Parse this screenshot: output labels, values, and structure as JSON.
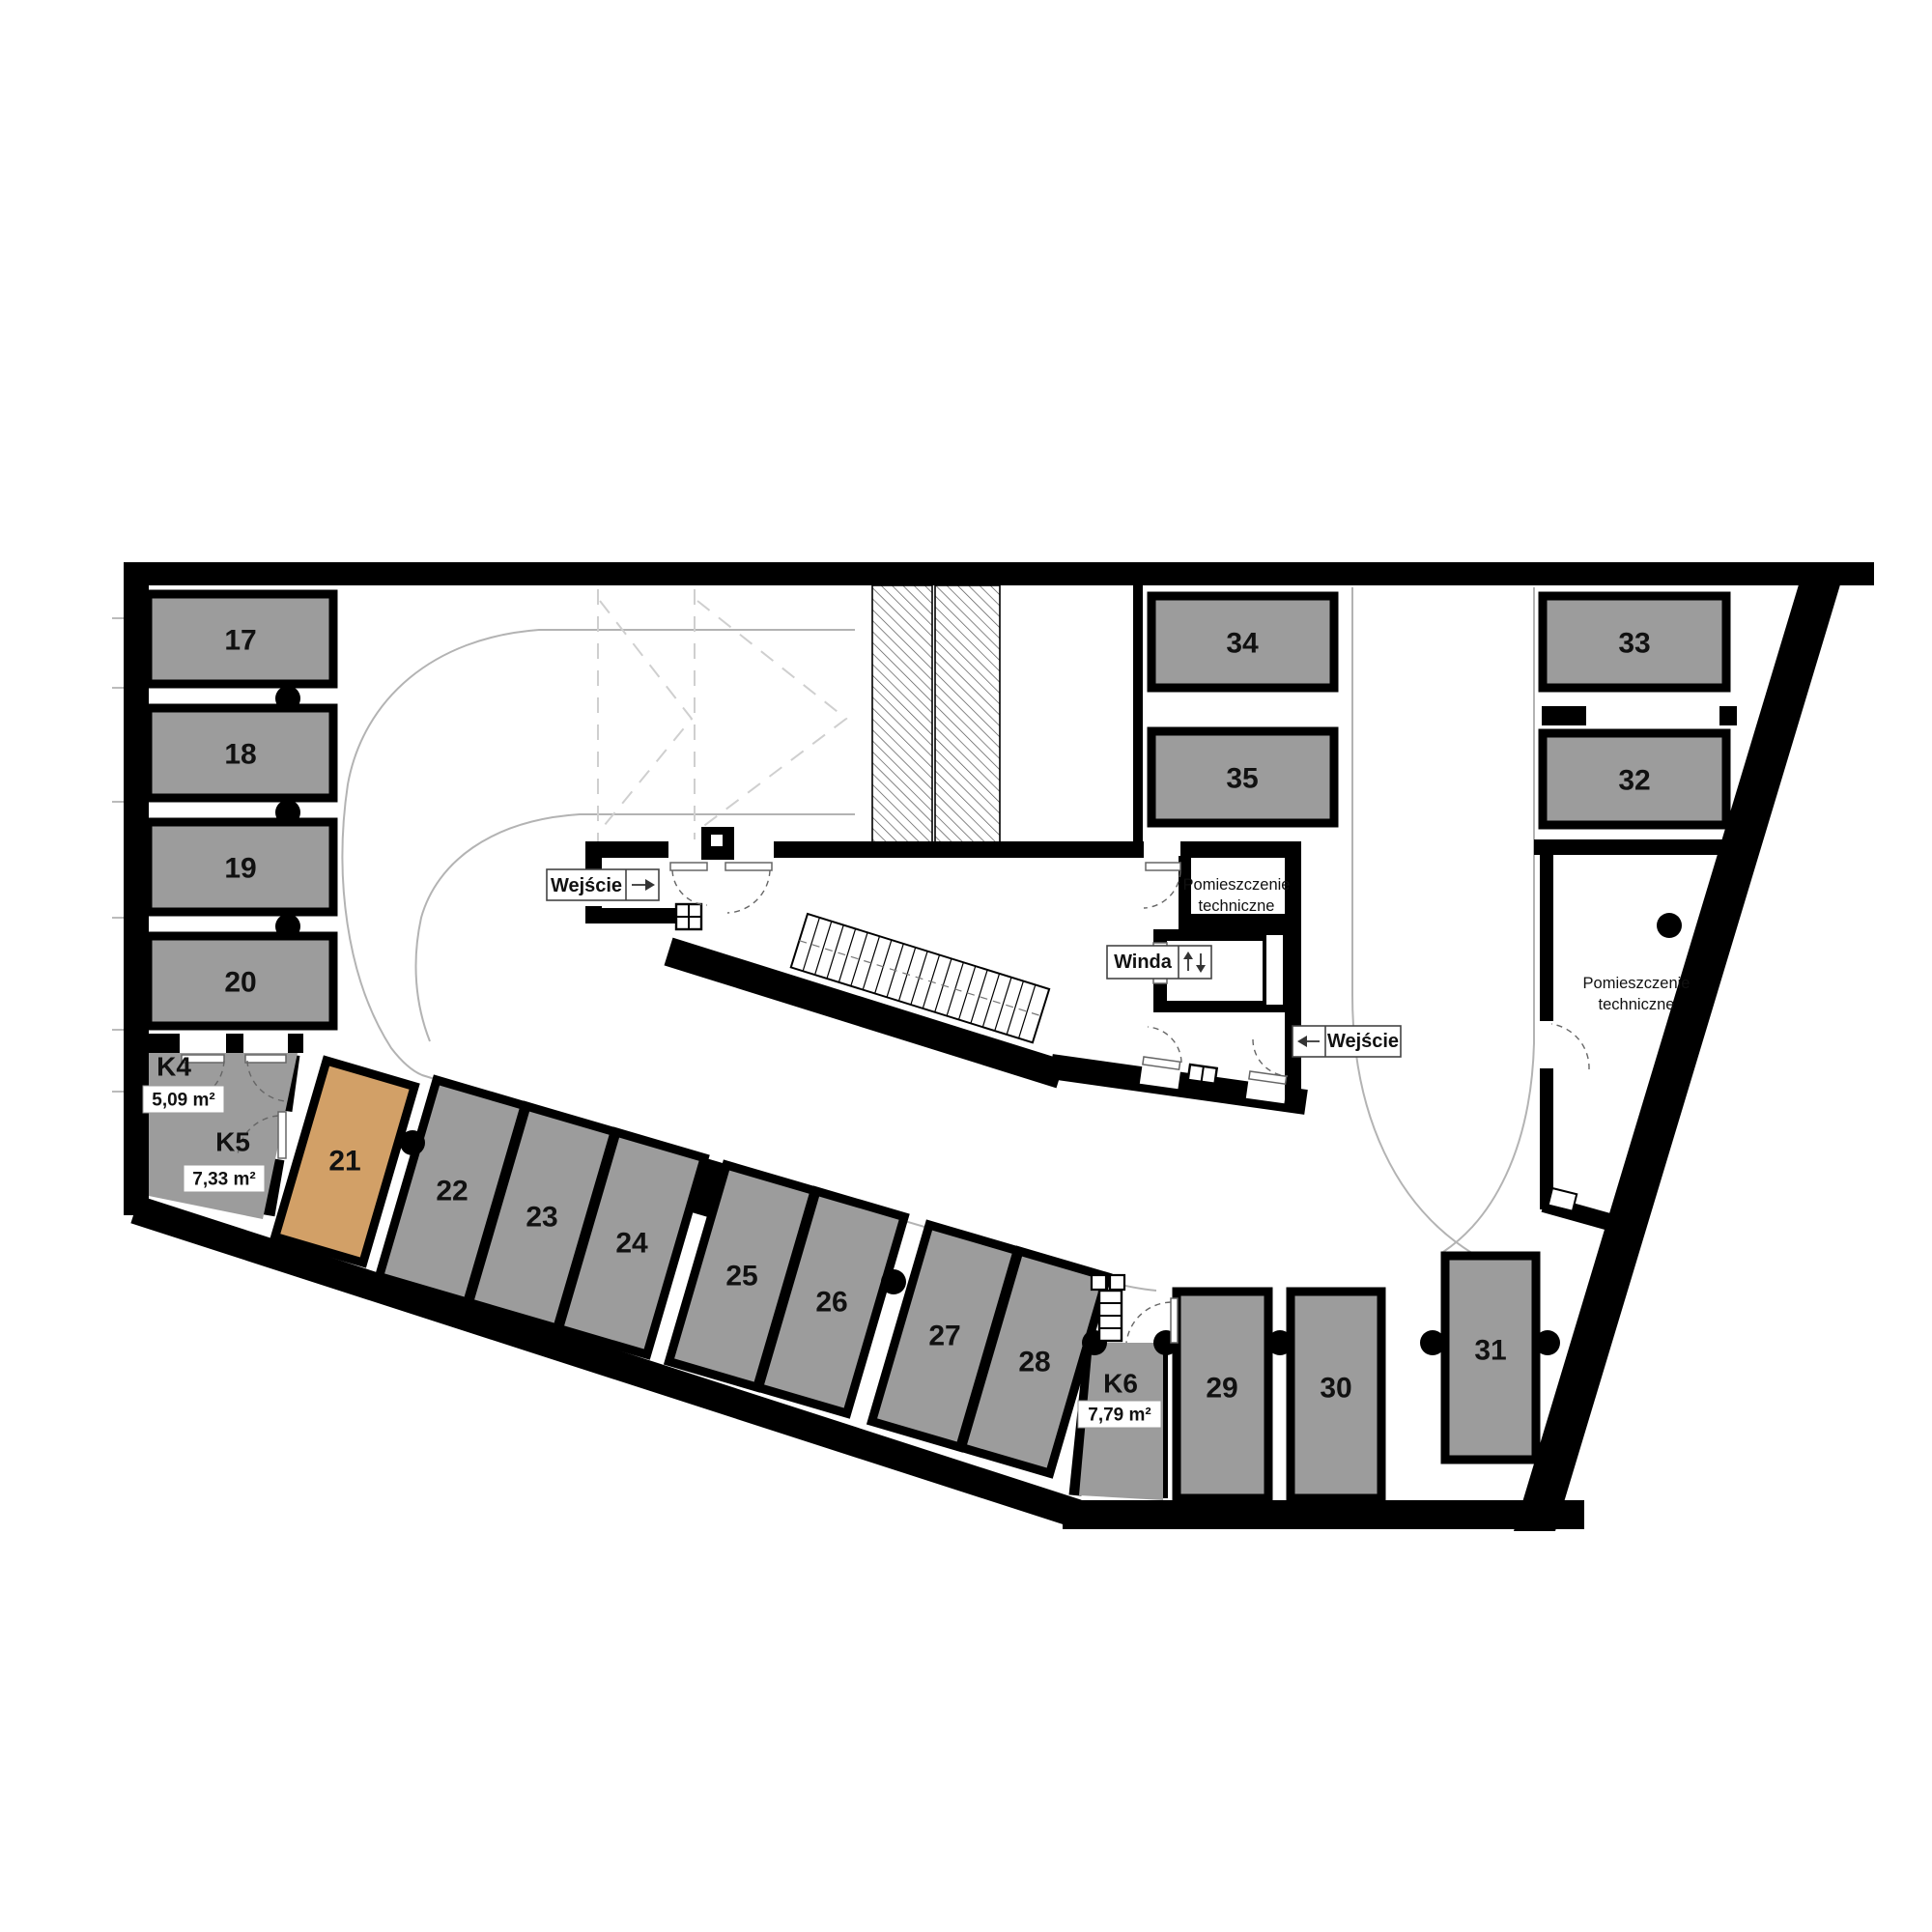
{
  "plan": {
    "colors": {
      "wall": "#000000",
      "space_fill": "#9c9c9c",
      "highlight_fill": "#d2a067",
      "lane_line": "#b3b3b3",
      "door_arc": "#666666"
    },
    "spaces": {
      "s17": {
        "label": "17"
      },
      "s18": {
        "label": "18"
      },
      "s19": {
        "label": "19"
      },
      "s20": {
        "label": "20"
      },
      "s21": {
        "label": "21",
        "highlighted": true
      },
      "s22": {
        "label": "22"
      },
      "s23": {
        "label": "23"
      },
      "s24": {
        "label": "24"
      },
      "s25": {
        "label": "25"
      },
      "s26": {
        "label": "26"
      },
      "s27": {
        "label": "27"
      },
      "s28": {
        "label": "28"
      },
      "s29": {
        "label": "29"
      },
      "s30": {
        "label": "30"
      },
      "s31": {
        "label": "31"
      },
      "s32": {
        "label": "32"
      },
      "s33": {
        "label": "33"
      },
      "s34": {
        "label": "34"
      },
      "s35": {
        "label": "35"
      }
    },
    "storage_rooms": {
      "k4": {
        "label": "K4",
        "area": "5,09 m²"
      },
      "k5": {
        "label": "K5",
        "area": "7,33 m²"
      },
      "k6": {
        "label": "K6",
        "area": "7,79 m²"
      }
    },
    "technical_rooms": {
      "core": {
        "line1": "Pomieszczenie",
        "line2": "techniczne"
      },
      "right": {
        "line1": "Pomieszczenie",
        "line2": "techniczne"
      }
    },
    "entrances": {
      "left": {
        "label": "Wejście",
        "direction": "right"
      },
      "right": {
        "label": "Wejście",
        "direction": "left"
      }
    },
    "elevator": {
      "label": "Winda"
    }
  }
}
